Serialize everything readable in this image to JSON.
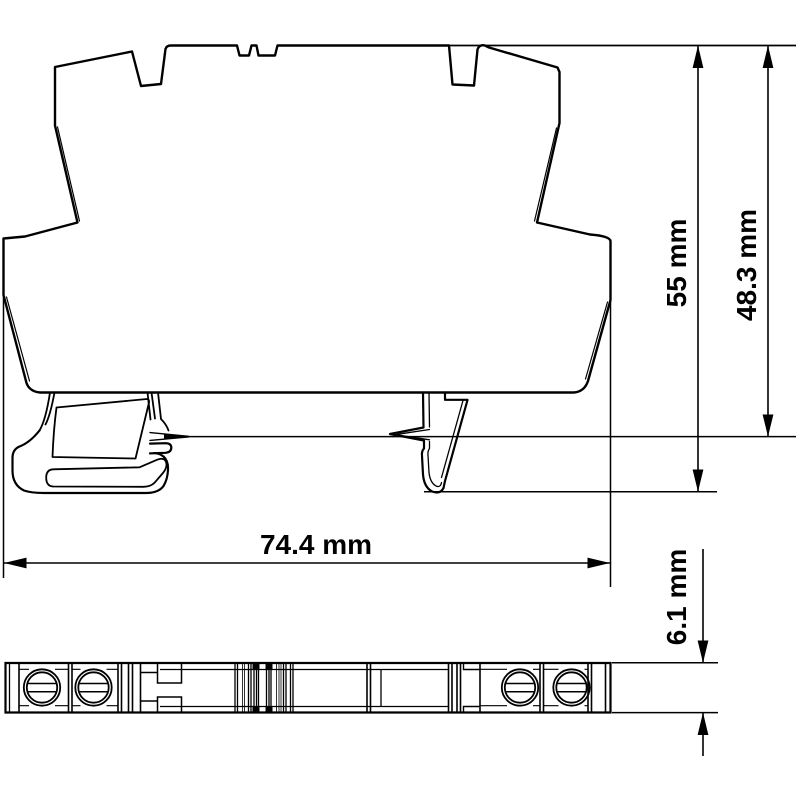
{
  "colors": {
    "line": "#000000",
    "background": "#ffffff"
  },
  "dimensions": {
    "height_total": {
      "label": "55 mm",
      "value": 55,
      "unit": "mm"
    },
    "height_rail": {
      "label": "48.3 mm",
      "value": 48.3,
      "unit": "mm"
    },
    "width_total": {
      "label": "74.4 mm",
      "value": 74.4,
      "unit": "mm"
    },
    "depth": {
      "label": "6.1 mm",
      "value": 6.1,
      "unit": "mm"
    }
  }
}
